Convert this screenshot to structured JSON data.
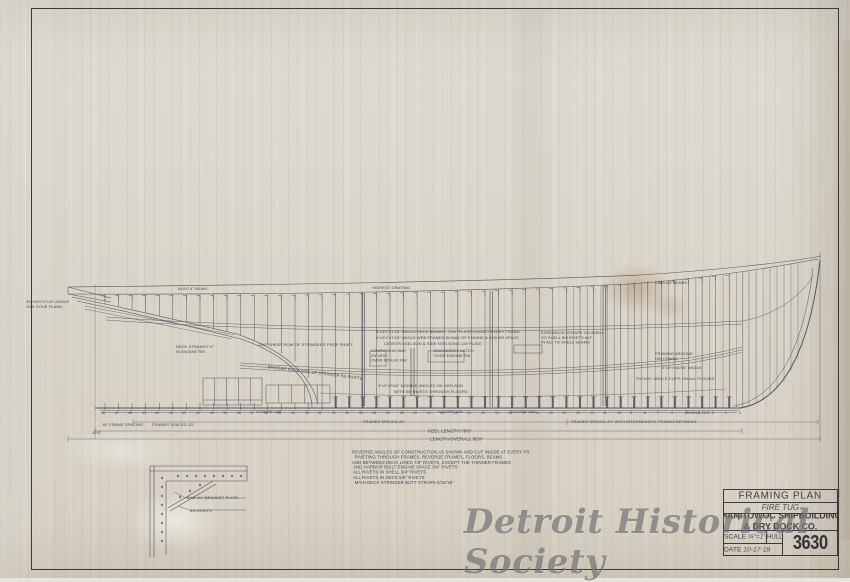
{
  "colors": {
    "paper": "#d9d4c8",
    "ink": "#4a4954",
    "watermark": "#58585b",
    "stain": "#966238"
  },
  "watermark_text": "Detroit Historical Society",
  "title_block": {
    "title": "FRAMING PLAN",
    "subtitle": "FIRE TUG",
    "company_line1": "MANITOWOC SHIPBUILDING",
    "company_line2": "& DRY DOCK CO.",
    "scale_label": "SCALE",
    "scale_value": "¾\"=1'-0\"",
    "hull_label": "HULL No.",
    "date_label": "DATE",
    "date_value": "10-17-18",
    "drawing_number": "3630",
    "margin_note": "3630-44-2"
  },
  "principal_dimensions": {
    "frames_spaced": "FRAMES SPACED 20\"",
    "keel_length": "KEEL LENGTH 78'0\"",
    "length_overall": "LENGTH OVERALL 85'9\""
  },
  "notes": [
    "REVERSE ANGLES OF CONSTRUCTION AS SHOWN AND CUT INSIDE AT EVERY FR.",
    "  RIVETING THROUGH FRAMES, REVERSE FRAMES, FLOORS, BEAMS",
    "AND BETWEEN DECK LINES 7/8\" RIVETS, EXCEPT THE THINNER FRAMES",
    " AND HARBOR BUILT ENGINE SPACE 3/4\" RIVETS",
    " ALL RIVETS IN SHELL 3/4\" RIVETS",
    " ALL RIVETS IN DECK 5/8\" RIVETS",
    "  MAIN DECK STRINGER BUTT STRAPS 5/16\"x6\""
  ],
  "annotations": [
    {
      "x": 26,
      "y": 300,
      "s": 4,
      "t": "4½\"x3½\"x7/16\" ANGLE\nOAK COVE PLANK"
    },
    {
      "x": 178,
      "y": 287,
      "s": 4,
      "t": "ALSO 4\" BEAM"
    },
    {
      "x": 372,
      "y": 286,
      "s": 4,
      "t": "HIGHEST GRATING"
    },
    {
      "x": 655,
      "y": 281,
      "s": 4,
      "t": "SIMILAR BEAMS"
    },
    {
      "x": 176,
      "y": 345,
      "s": 4,
      "t": "DECK STRAKES ⅜\"\nIN ENGINE RM"
    },
    {
      "x": 258,
      "y": 343,
      "s": 4,
      "t": "ONE SHEER ROW OF STRINGERS PROP SHAFT"
    },
    {
      "x": 268,
      "y": 365,
      "s": 4,
      "r": 7,
      "t": "BRACKET EACH SIDE OF STRINGER 5/8 RIVETS"
    },
    {
      "x": 376,
      "y": 330,
      "s": 4,
      "t": "5\"x3½\"x7/16\" ANGLE DECK BEAMS - 7/16\" PLATE GUSSET EVERY FRAME"
    },
    {
      "x": 376,
      "y": 336,
      "s": 4,
      "t": "6\"x3½\"x7/16\" ANGLE WEB FRAMES IN WAY OF ENGINE & BOILER SPACE"
    },
    {
      "x": 384,
      "y": 342,
      "s": 4,
      "t": "CENTER KEELSON & SIDE KEELSONS 12# PLATE"
    },
    {
      "x": 371,
      "y": 349,
      "s": 4,
      "t": "COMPANION WAY\n4'6\"x5'6\"\nOVER BOILER RM"
    },
    {
      "x": 434,
      "y": 349,
      "s": 4,
      "t": "MACHINERY HATCH\nOVER ENGINE RM"
    },
    {
      "x": 378,
      "y": 384,
      "s": 4,
      "t": "3\"x3\"x7/16\" DOUBLE ANGLES ON KEELSON"
    },
    {
      "x": 394,
      "y": 390,
      "s": 4,
      "t": "WITH 5/8 RIVETS THROUGH FLOORS"
    },
    {
      "x": 541,
      "y": 331,
      "s": 4,
      "t": "EXPANSION STRAPS ON SHELL\nTO SHELL 5/8 RIVETS ALT.\nIN ALL TO SHELL SEAMS"
    },
    {
      "x": 655,
      "y": 352,
      "s": 4,
      "t": "FRAMING AROUND\nHATCHWAY"
    },
    {
      "x": 662,
      "y": 366,
      "s": 4,
      "t": "3\"x2½\"x5/16\" ANGLE"
    },
    {
      "x": 636,
      "y": 377,
      "s": 4,
      "t": "2½\"x2½\" ANGLE CLIPS ON ALL FLOORS"
    },
    {
      "x": 686,
      "y": 411,
      "s": 4,
      "t": "RISING 25'6\""
    },
    {
      "x": 256,
      "y": 410,
      "s": 4,
      "t": "FLOORS 10#"
    },
    {
      "x": 438,
      "y": 410,
      "s": 4,
      "t": "FLOORS 15#"
    },
    {
      "x": 510,
      "y": 410,
      "s": 4,
      "t": "FLOORS 15#"
    },
    {
      "x": 571,
      "y": 420,
      "s": 4,
      "t": "FRAMES SPACED 20\" WITH INTERMEDIATE FRAMES BETWEEN"
    },
    {
      "x": 363,
      "y": 420,
      "s": 4,
      "t": "FRAMES SPACED 20\""
    },
    {
      "x": 102,
      "y": 423,
      "s": 4,
      "t": "16\" FRAME SPACING"
    },
    {
      "x": 152,
      "y": 423,
      "s": 4,
      "t": "FRAMES SPACED 20\""
    },
    {
      "x": 92,
      "y": 431,
      "s": 4,
      "t": "10'6\""
    },
    {
      "x": 428,
      "y": 429,
      "s": 4.5,
      "t": "KEEL LENGTH 78'0\""
    },
    {
      "x": 430,
      "y": 437,
      "s": 4.5,
      "t": "LENGTH OVERALL 85'9\""
    },
    {
      "x": 187,
      "y": 496,
      "s": 4,
      "t": "6\"x6\"x⅜\" BRACKET PLATE"
    },
    {
      "x": 190,
      "y": 509,
      "s": 4,
      "t": "5/8 RIVETS"
    }
  ],
  "frame_numbers": [
    "48",
    "47",
    "46",
    "45",
    "44",
    "43",
    "42",
    "41",
    "40",
    "39",
    "38",
    "37",
    "36",
    "35",
    "34",
    "33",
    "32",
    "31",
    "30",
    "29",
    "28",
    "27",
    "26",
    "25",
    "24",
    "23",
    "22",
    "21",
    "20",
    "19",
    "18",
    "17",
    "16",
    "15",
    "14",
    "13",
    "12",
    "11",
    "10",
    "9",
    "8",
    "7",
    "6",
    "5",
    "4",
    "3",
    "2",
    "1"
  ]
}
